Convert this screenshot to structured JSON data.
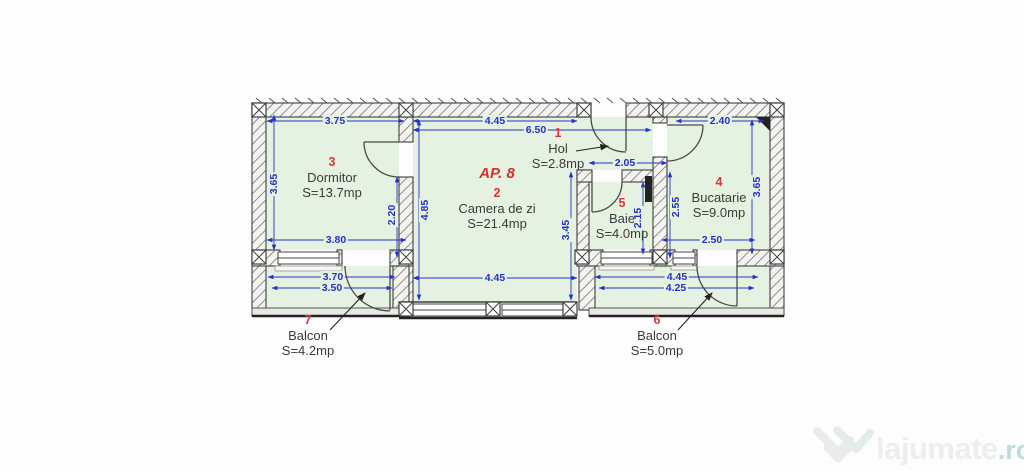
{
  "title": "AP. 8",
  "rooms": [
    {
      "number": "1",
      "name": "Hol",
      "area": "S=2.8mp"
    },
    {
      "number": "2",
      "name": "Camera de zi",
      "area": "S=21.4mp"
    },
    {
      "number": "3",
      "name": "Dormitor",
      "area": "S=13.7mp"
    },
    {
      "number": "4",
      "name": "Bucatarie",
      "area": "S=9.0mp"
    },
    {
      "number": "5",
      "name": "Baie",
      "area": "S=4.0mp"
    },
    {
      "number": "6",
      "name": "Balcon",
      "area": "S=5.0mp"
    },
    {
      "number": "7",
      "name": "Balcon",
      "area": "S=4.2mp"
    }
  ],
  "dimensions": {
    "dorm_top": "3.75",
    "dorm_left": "3.65",
    "dorm_bottom": "3.80",
    "dorm_door": "2.20",
    "cam_top": "4.45",
    "cam_total": "6.50",
    "cam_left": "4.85",
    "cam_right": "3.45",
    "cam_bottom": "4.45",
    "hol_width": "2.05",
    "baie_height": "2.15",
    "buc_top": "2.40",
    "buc_left": "2.55",
    "buc_right": "3.65",
    "buc_bottom": "2.50",
    "balc7_outer": "3.70",
    "balc7_inner": "3.50",
    "balc6_outer": "4.45",
    "balc6_inner": "4.25"
  },
  "watermark": {
    "brand": "lajumate",
    "tld": ".ro"
  },
  "colors": {
    "room_fill": "#e5f2e1",
    "dimension_blue": "#2531c8",
    "accent_red": "#e03434",
    "wall_dark": "#3e3e3e",
    "watermark_teal": "#bfdcdd"
  }
}
